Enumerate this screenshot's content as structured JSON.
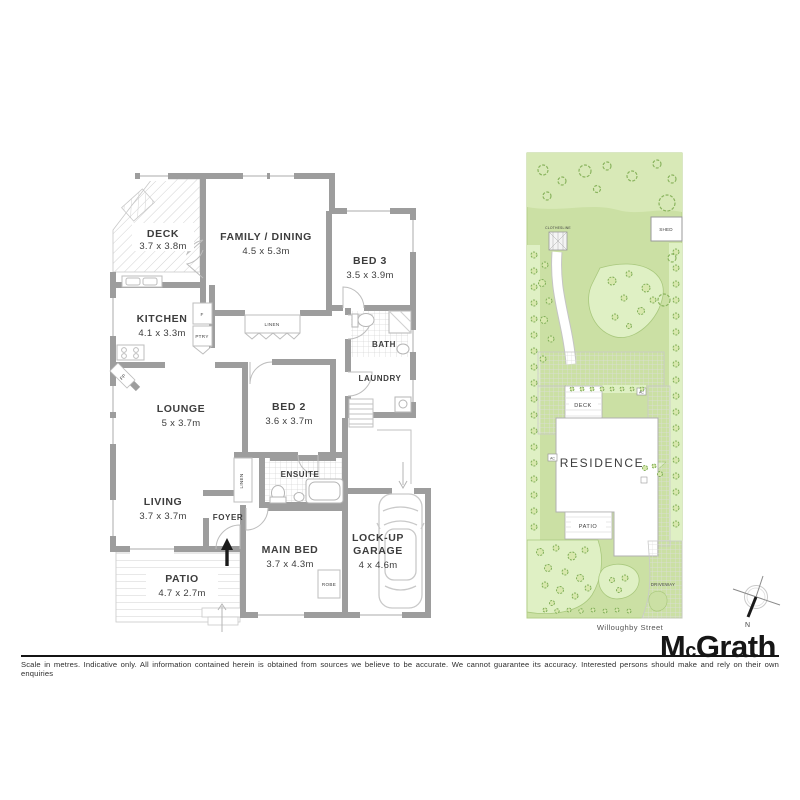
{
  "floorplan": {
    "rooms": [
      {
        "name": "DECK",
        "dims": "3.7 x 3.8m"
      },
      {
        "name": "FAMILY / DINING",
        "dims": "4.5 x 5.3m"
      },
      {
        "name": "BED 3",
        "dims": "3.5 x 3.9m"
      },
      {
        "name": "KITCHEN",
        "dims": "4.1 x 3.3m"
      },
      {
        "name": "LOUNGE",
        "dims": "5 x 3.7m"
      },
      {
        "name": "BED 2",
        "dims": "3.6 x 3.7m"
      },
      {
        "name": "LIVING",
        "dims": "3.7 x 3.7m"
      },
      {
        "name": "PATIO",
        "dims": "4.7 x 2.7m"
      },
      {
        "name": "MAIN BED",
        "dims": "3.7 x 4.3m"
      },
      {
        "name": "LOCK-UP GARAGE",
        "line1": "LOCK-UP",
        "line2": "GARAGE",
        "dims": "4 x 4.6m"
      }
    ],
    "labels": {
      "bath": "BATH",
      "laundry": "LAUNDRY",
      "ensuite": "ENSUITE",
      "foyer": "FOYER",
      "linen": "LINEN",
      "linen2": "LINEN",
      "robe": "ROBE",
      "fridge": "F",
      "pantry": "PTRY",
      "fireplace": "FP"
    }
  },
  "siteplan": {
    "clothesline": "CLOTHESLINE",
    "shed": "SHED",
    "deck": "DECK",
    "residence": "RESIDENCE",
    "patio": "PATIO",
    "driveway": "DRIVEWAY",
    "ac": "AC",
    "street": "Willoughby Street"
  },
  "compass": {
    "north": "N"
  },
  "brand": {
    "m": "M",
    "c": "c",
    "rest": "Grath"
  },
  "footer": {
    "disclaimer": "Scale in metres. Indicative only. All information contained herein is obtained from sources we believe to be accurate. We cannot guarantee its accuracy. Interested persons should make and rely on their own enquiries"
  },
  "colors": {
    "wall": "#9d9d9d",
    "lawn": "#cbe0a4",
    "garden_bed": "#dff0c4",
    "shrub_stroke": "#7fae57",
    "text": "#3d3d3d",
    "brand_text": "#161616"
  }
}
